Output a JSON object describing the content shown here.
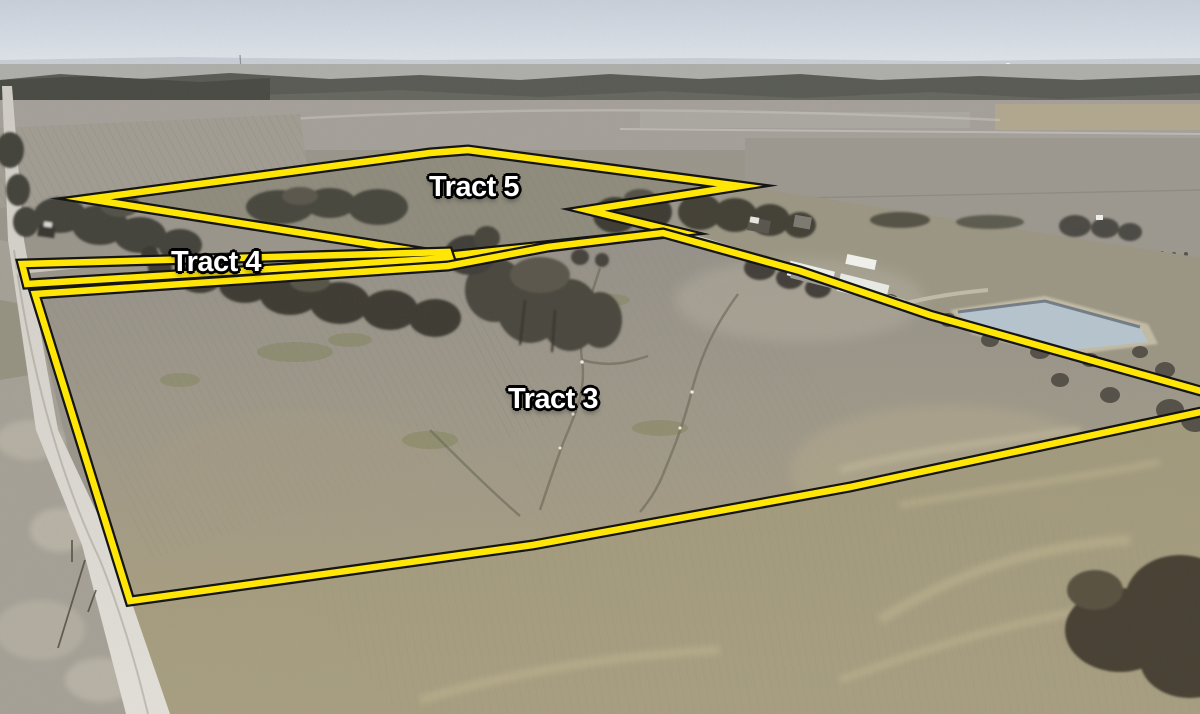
{
  "scene": {
    "type": "aerial-photo-with-tract-outlines",
    "labels_visible": [
      "Tract 5",
      "Tract 4",
      "Tract 3"
    ]
  },
  "style": {
    "outline_color": "#ffe606",
    "outline_edge_color": "#151515",
    "label_color": "#ffffff",
    "label_outline_color": "#000000"
  },
  "tracts": [
    {
      "id": "tract-5",
      "label": "Tract 5",
      "outline_points": "88,199 430,153 468,150 740,186 588,210 678,232 447,256"
    },
    {
      "id": "tract-4",
      "label": "Tract 4",
      "outline_points": "22,264 448,252 450,258 27,284"
    },
    {
      "id": "tract-3",
      "label": "Tract 3",
      "outline_points": "35,294 448,266 548,247 663,233 800,271 930,315 1215,395 1215,409 850,487 533,545 130,601"
    }
  ]
}
